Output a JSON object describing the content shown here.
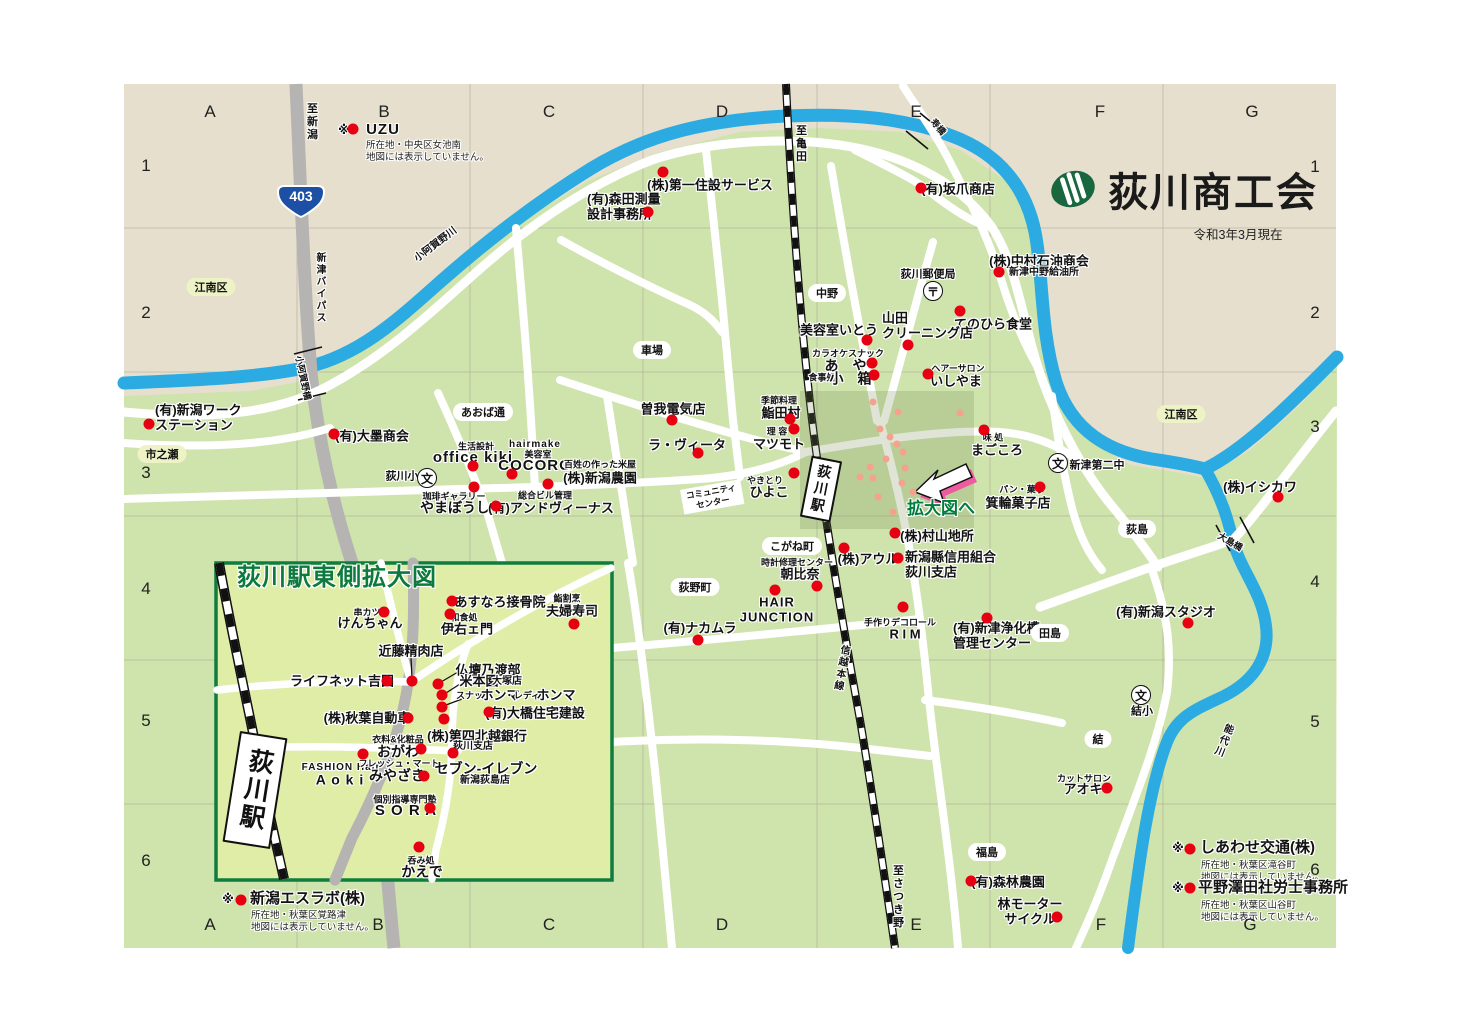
{
  "header": {
    "title": "荻川商工会",
    "date": "令和3年3月現在",
    "logo_icon": "green-striped-oval"
  },
  "map": {
    "route_shield": "403",
    "arrow_label": "拡大図へ",
    "colors": {
      "land": "#e6dfcd",
      "green": "#cfe3ac",
      "inset_green": "#e0eda6",
      "river": "#2babe2",
      "road_gray": "#b5b4b2",
      "rail": "#111111",
      "poi_red": "#e60012",
      "poi_salmon": "#f4a28e",
      "accent_green": "#007c3d",
      "shield_blue": "#1d50a5",
      "arrow_shadow": "#ef5ba1"
    },
    "grid": {
      "letters": [
        "A",
        "B",
        "C",
        "D",
        "E",
        "F",
        "G"
      ],
      "top_y": 112,
      "bottom_y": 925,
      "cols_top": [
        210,
        384,
        549,
        722,
        916,
        1100,
        1252
      ],
      "cols_bottom": [
        210,
        378,
        549,
        722,
        916,
        1101,
        1250
      ],
      "numbers": [
        "1",
        "2",
        "3",
        "4",
        "5",
        "6"
      ],
      "left_x": 146,
      "right_x": 1315,
      "rows_left": [
        166,
        313,
        473,
        589,
        721,
        861
      ],
      "rows_right": [
        167,
        313,
        427,
        582,
        722,
        870
      ]
    },
    "labels": [
      {
        "t": "※",
        "x": 344,
        "y": 130,
        "c": "f12",
        "id": "star-uzu"
      },
      {
        "t": "UZU",
        "x": 383,
        "y": 130,
        "c": "n15 lat",
        "id": "label-uzu"
      },
      {
        "t": "所在地・中央区女池南\n地図には表示していません。",
        "x": 366,
        "y": 140,
        "c": "note",
        "a": "lt"
      },
      {
        "t": "(株)第一住設サービス",
        "x": 710,
        "y": 185
      },
      {
        "t": "(有)森田測量\n設計事務所",
        "x": 587,
        "y": 207,
        "c": "L",
        "a": "l"
      },
      {
        "t": "(有)坂爪商店",
        "x": 958,
        "y": 189
      },
      {
        "t": "(株)中村石油商会",
        "x": 1039,
        "y": 261
      },
      {
        "t": "新津中野給油所",
        "x": 1044,
        "y": 273,
        "c": "s10"
      },
      {
        "t": "荻川郵便局",
        "x": 928,
        "y": 275,
        "c": "s11"
      },
      {
        "t": "てのひら食堂",
        "x": 993,
        "y": 324
      },
      {
        "t": "美容室いとう",
        "x": 839,
        "y": 330
      },
      {
        "t": "山田\nクリーニング店",
        "x": 882,
        "y": 326,
        "c": "L",
        "a": "l"
      },
      {
        "t": "カラオケスナック",
        "x": 848,
        "y": 354,
        "c": "s9"
      },
      {
        "t": "あ や",
        "x": 848,
        "y": 366,
        "c": "f14 sp"
      },
      {
        "t": "食事処",
        "x": 822,
        "y": 378,
        "c": "s9"
      },
      {
        "t": "小 箱",
        "x": 853,
        "y": 379,
        "c": "f14 sp"
      },
      {
        "t": "ヘアーサロン",
        "x": 958,
        "y": 369,
        "c": "s9"
      },
      {
        "t": "いしやま",
        "x": 956,
        "y": 381
      },
      {
        "t": "曽我電気店",
        "x": 673,
        "y": 409
      },
      {
        "t": "ラ・ヴィータ",
        "x": 687,
        "y": 445
      },
      {
        "t": "季節料理",
        "x": 779,
        "y": 401,
        "c": "s9"
      },
      {
        "t": "鮨田村",
        "x": 781,
        "y": 413
      },
      {
        "t": "理 容",
        "x": 777,
        "y": 432,
        "c": "s9"
      },
      {
        "t": "マツモト",
        "x": 779,
        "y": 444
      },
      {
        "t": "やきとり",
        "x": 765,
        "y": 481,
        "c": "s9"
      },
      {
        "t": "ひよこ",
        "x": 769,
        "y": 492
      },
      {
        "t": "味 処",
        "x": 993,
        "y": 438,
        "c": "s9"
      },
      {
        "t": "まごころ",
        "x": 997,
        "y": 450
      },
      {
        "t": "パン・菓子",
        "x": 1022,
        "y": 490,
        "c": "s9"
      },
      {
        "t": "箕輪菓子店",
        "x": 1018,
        "y": 503
      },
      {
        "t": "(株)村山地所",
        "x": 937,
        "y": 536
      },
      {
        "t": "(株)アウル",
        "x": 868,
        "y": 559
      },
      {
        "t": "新潟縣信用組合\n荻川支店",
        "x": 905,
        "y": 565,
        "c": "L",
        "a": "l"
      },
      {
        "t": "時計修理センター",
        "x": 797,
        "y": 563,
        "c": "s9"
      },
      {
        "t": "朝比奈",
        "x": 800,
        "y": 574
      },
      {
        "t": "HAIR\nJUNCTION",
        "x": 777,
        "y": 610,
        "c": "lat"
      },
      {
        "t": "手作りデコロール",
        "x": 900,
        "y": 623,
        "c": "s9"
      },
      {
        "t": "R I M",
        "x": 905,
        "y": 634
      },
      {
        "t": "(有)新津浄化槽\n管理センター",
        "x": 953,
        "y": 636,
        "c": "L",
        "a": "l"
      },
      {
        "t": "(有)ナカムラ",
        "x": 700,
        "y": 628
      },
      {
        "t": "(有)新潟スタジオ",
        "x": 1166,
        "y": 612
      },
      {
        "t": "(株)イシカワ",
        "x": 1260,
        "y": 487
      },
      {
        "t": "新津第二中",
        "x": 1097,
        "y": 466,
        "c": "s11"
      },
      {
        "t": "荻川小",
        "x": 402,
        "y": 477,
        "c": "s11"
      },
      {
        "t": "結小",
        "x": 1142,
        "y": 712,
        "c": "s11"
      },
      {
        "t": "カットサロン",
        "x": 1084,
        "y": 779,
        "c": "s9"
      },
      {
        "t": "アオキ",
        "x": 1083,
        "y": 789
      },
      {
        "t": "(有)森林農園",
        "x": 1008,
        "y": 882
      },
      {
        "t": "林モーター\nサイクル",
        "x": 1030,
        "y": 912
      },
      {
        "t": "(有)新潟ワーク\nステーション",
        "x": 155,
        "y": 418,
        "c": "L",
        "a": "l"
      },
      {
        "t": "(有)大墨商会",
        "x": 372,
        "y": 436
      },
      {
        "t": "生活設計",
        "x": 476,
        "y": 447,
        "c": "s9"
      },
      {
        "t": "office kiki",
        "x": 473,
        "y": 458,
        "c": "f15 lat"
      },
      {
        "t": "hairmake",
        "x": 535,
        "y": 445,
        "c": "s10 lat"
      },
      {
        "t": "美容室",
        "x": 538,
        "y": 455,
        "c": "s9"
      },
      {
        "t": "COCORO",
        "x": 535,
        "y": 466,
        "c": "f15 lat"
      },
      {
        "t": "百姓の作った米屋",
        "x": 600,
        "y": 465,
        "c": "s9"
      },
      {
        "t": "(株)新潟農園",
        "x": 600,
        "y": 478
      },
      {
        "t": "珈琲ギャラリー",
        "x": 454,
        "y": 497,
        "c": "s9"
      },
      {
        "t": "やまぼうし",
        "x": 455,
        "y": 508,
        "c": "f14"
      },
      {
        "t": "総合ビル管理",
        "x": 545,
        "y": 496,
        "c": "s9"
      },
      {
        "t": "(有)アンドヴィーナス",
        "x": 551,
        "y": 508
      },
      {
        "t": "至新潟",
        "x": 311,
        "y": 122,
        "c": "vert s11",
        "id": "road-to-niigata"
      },
      {
        "t": "新津バイパス",
        "x": 319,
        "y": 288,
        "c": "vert s10",
        "id": "niitsu-bypass"
      },
      {
        "t": "小阿賀野橋",
        "x": 303,
        "y": 378,
        "c": "s9",
        "r": 78
      },
      {
        "t": "小阿賀野川",
        "x": 436,
        "y": 245,
        "c": "s10",
        "r": -37,
        "id": "koagano-river"
      },
      {
        "t": "至亀田",
        "x": 800,
        "y": 144,
        "c": "vert s11"
      },
      {
        "t": "寿橋",
        "x": 938,
        "y": 127,
        "c": "s9",
        "r": 50
      },
      {
        "t": "信越本線",
        "x": 840,
        "y": 668,
        "c": "vert s10",
        "r": 10,
        "id": "shinetsu-line"
      },
      {
        "t": "至さつき野",
        "x": 897,
        "y": 897,
        "c": "vert s11"
      },
      {
        "t": "能代川",
        "x": 1222,
        "y": 740,
        "c": "vert s10",
        "r": 22,
        "id": "noushiro-river"
      },
      {
        "t": "大島橋",
        "x": 1230,
        "y": 542,
        "c": "s9",
        "r": 30
      },
      {
        "t": "※",
        "x": 228,
        "y": 899,
        "c": "f12"
      },
      {
        "t": "新潟エスラボ(株)",
        "x": 250,
        "y": 899,
        "c": "n15",
        "a": "l"
      },
      {
        "t": "所在地・秋葉区覚路津\n地図には表示していません。",
        "x": 251,
        "y": 910,
        "c": "note",
        "a": "lt"
      },
      {
        "t": "※",
        "x": 1178,
        "y": 848,
        "c": "f12"
      },
      {
        "t": "しあわせ交通(株)",
        "x": 1200,
        "y": 848,
        "c": "n15",
        "a": "l"
      },
      {
        "t": "所在地・秋葉区滝谷町\n地図には表示していません。",
        "x": 1201,
        "y": 860,
        "c": "note",
        "a": "lt"
      },
      {
        "t": "※",
        "x": 1178,
        "y": 888,
        "c": "f12"
      },
      {
        "t": "平野澤田社労士事務所",
        "x": 1198,
        "y": 888,
        "c": "n15",
        "a": "l"
      },
      {
        "t": "所在地・秋葉区山谷町\n地図には表示していません。",
        "x": 1201,
        "y": 900,
        "c": "note",
        "a": "lt"
      }
    ],
    "bubbles": [
      {
        "t": "江南区",
        "x": 211,
        "y": 287,
        "area": true
      },
      {
        "t": "江南区",
        "x": 1181,
        "y": 414,
        "area": true
      },
      {
        "t": "市之瀬",
        "x": 162,
        "y": 454,
        "area": true
      },
      {
        "t": "中野",
        "x": 827,
        "y": 293
      },
      {
        "t": "車場",
        "x": 652,
        "y": 350
      },
      {
        "t": "あおば通",
        "x": 483,
        "y": 412
      },
      {
        "t": "こがね町",
        "x": 792,
        "y": 546
      },
      {
        "t": "荻野町",
        "x": 695,
        "y": 587
      },
      {
        "t": "荻島",
        "x": 1137,
        "y": 529
      },
      {
        "t": "田島",
        "x": 1050,
        "y": 633
      },
      {
        "t": "福島",
        "x": 987,
        "y": 852
      },
      {
        "t": "結",
        "x": 1098,
        "y": 739
      }
    ],
    "community_center": {
      "t": "コミュニティ\nセンター",
      "x": 712,
      "y": 497
    },
    "stations": [
      {
        "label": "荻川駅",
        "x": 821,
        "y": 489,
        "w": 27,
        "h": 58,
        "r": 11,
        "fs": 14
      },
      {
        "label": "荻川駅",
        "x": 255,
        "y": 790,
        "w": 44,
        "h": 108,
        "r": 9,
        "fs": 25
      }
    ],
    "schools": [
      {
        "x": 427,
        "y": 478
      },
      {
        "x": 1058,
        "y": 463
      },
      {
        "x": 1141,
        "y": 695
      }
    ],
    "school_symbol": "文",
    "post_offices": [
      {
        "x": 933,
        "y": 291
      }
    ],
    "post_symbol": "〒",
    "dots_red": [
      [
        353,
        129
      ],
      [
        663,
        172
      ],
      [
        648,
        212
      ],
      [
        921,
        188
      ],
      [
        999,
        272
      ],
      [
        960,
        311
      ],
      [
        867,
        340
      ],
      [
        908,
        345
      ],
      [
        872,
        363
      ],
      [
        874,
        375
      ],
      [
        928,
        374
      ],
      [
        672,
        420
      ],
      [
        698,
        453
      ],
      [
        790,
        419
      ],
      [
        794,
        429
      ],
      [
        794,
        473
      ],
      [
        984,
        430
      ],
      [
        1040,
        487
      ],
      [
        895,
        533
      ],
      [
        844,
        548
      ],
      [
        898,
        558
      ],
      [
        775,
        590
      ],
      [
        817,
        586
      ],
      [
        903,
        607
      ],
      [
        987,
        618
      ],
      [
        1188,
        623
      ],
      [
        1278,
        497
      ],
      [
        1107,
        788
      ],
      [
        971,
        881
      ],
      [
        1057,
        917
      ],
      [
        149,
        424
      ],
      [
        334,
        434
      ],
      [
        473,
        466
      ],
      [
        512,
        474
      ],
      [
        548,
        484
      ],
      [
        474,
        487
      ],
      [
        496,
        506
      ],
      [
        698,
        640
      ],
      [
        241,
        900
      ],
      [
        1190,
        849
      ],
      [
        1190,
        888
      ],
      [
        384,
        612
      ],
      [
        452,
        601
      ],
      [
        450,
        614
      ],
      [
        574,
        624
      ],
      [
        412,
        681
      ],
      [
        387,
        681
      ],
      [
        438,
        684
      ],
      [
        442,
        695
      ],
      [
        442,
        707
      ],
      [
        444,
        719
      ],
      [
        489,
        712
      ],
      [
        408,
        718
      ],
      [
        453,
        753
      ],
      [
        421,
        749
      ],
      [
        363,
        754
      ],
      [
        424,
        776
      ],
      [
        430,
        808
      ],
      [
        419,
        847
      ]
    ],
    "dots_salmon": [
      [
        873,
        402
      ],
      [
        898,
        412
      ],
      [
        960,
        413
      ],
      [
        880,
        429
      ],
      [
        890,
        437
      ],
      [
        897,
        444
      ],
      [
        903,
        452
      ],
      [
        886,
        459
      ],
      [
        870,
        467
      ],
      [
        905,
        468
      ],
      [
        860,
        477
      ],
      [
        873,
        478
      ],
      [
        902,
        483
      ],
      [
        913,
        492
      ],
      [
        878,
        497
      ],
      [
        916,
        505
      ],
      [
        893,
        512
      ]
    ]
  },
  "inset": {
    "title": "荻川駅東側拡大図",
    "labels": [
      {
        "t": "串カツ",
        "x": 367,
        "y": 613,
        "c": "s9"
      },
      {
        "t": "けんちゃん",
        "x": 370,
        "y": 623
      },
      {
        "t": "あすなろ接骨院",
        "x": 500,
        "y": 602
      },
      {
        "t": "和食処",
        "x": 464,
        "y": 618,
        "c": "s9"
      },
      {
        "t": "伊右ェ門",
        "x": 467,
        "y": 629
      },
      {
        "t": "鮨割烹",
        "x": 567,
        "y": 599,
        "c": "s9"
      },
      {
        "t": "夫婦寿司",
        "x": 572,
        "y": 611
      },
      {
        "t": "近藤精肉店",
        "x": 411,
        "y": 651
      },
      {
        "t": "ライフネット吉田",
        "x": 342,
        "y": 681
      },
      {
        "t": "仏壇乃渡部",
        "x": 488,
        "y": 670
      },
      {
        "t": "米本園",
        "x": 479,
        "y": 681
      },
      {
        "t": "大塚店",
        "x": 507,
        "y": 682,
        "c": "s10"
      },
      {
        "t": "スナック",
        "x": 474,
        "y": 696,
        "c": "s9"
      },
      {
        "t": "ホンマ",
        "x": 500,
        "y": 695
      },
      {
        "t": "・レディス",
        "x": 527,
        "y": 696,
        "c": "s9"
      },
      {
        "t": "ホンマ",
        "x": 556,
        "y": 695
      },
      {
        "t": "(有)大橋住宅建設",
        "x": 535,
        "y": 713
      },
      {
        "t": "(株)秋葉自動車",
        "x": 367,
        "y": 718
      },
      {
        "t": "(株)第四北越銀行",
        "x": 477,
        "y": 736
      },
      {
        "t": "荻川支店",
        "x": 473,
        "y": 747,
        "c": "s10"
      },
      {
        "t": "衣料&化粧品",
        "x": 398,
        "y": 740,
        "c": "s9"
      },
      {
        "t": "おがわ",
        "x": 398,
        "y": 752,
        "c": "f14"
      },
      {
        "t": "FASHION Hair",
        "x": 341,
        "y": 768,
        "c": "s10 lat"
      },
      {
        "t": "A o k i",
        "x": 340,
        "y": 780,
        "c": "f14 lat"
      },
      {
        "t": "フレッシュ・マート",
        "x": 399,
        "y": 764,
        "c": "s9"
      },
      {
        "t": "みやざき",
        "x": 397,
        "y": 776,
        "c": "f14"
      },
      {
        "t": "セブン-イレブン",
        "x": 486,
        "y": 769,
        "c": "f14"
      },
      {
        "t": "新潟荻島店",
        "x": 485,
        "y": 781,
        "c": "s10"
      },
      {
        "t": "個別指導専門塾",
        "x": 405,
        "y": 800,
        "c": "s9"
      },
      {
        "t": "S O R A",
        "x": 406,
        "y": 811,
        "c": "f15 lat"
      },
      {
        "t": "呑み処",
        "x": 421,
        "y": 861,
        "c": "s9"
      },
      {
        "t": "かえで",
        "x": 422,
        "y": 872,
        "c": "f14"
      }
    ]
  }
}
